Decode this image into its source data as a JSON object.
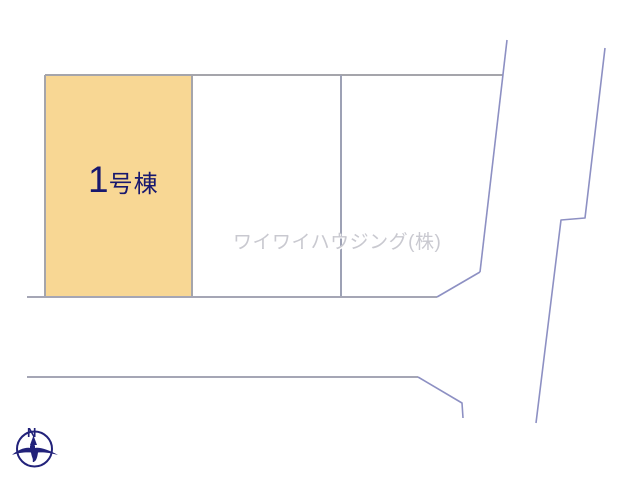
{
  "diagram": {
    "plot": {
      "label_number": "1",
      "label_suffix": "号棟",
      "full_label": "1号棟"
    },
    "watermark": "ワイワイハウジング(株)",
    "compass": {
      "north_label": "N"
    },
    "colors": {
      "plot_fill": "#f8d794",
      "plot_line": "#a5a5ab",
      "parcel_line": "#9da1b5",
      "road_line": "#a5a6b5",
      "boundary_line": "#8d90c3",
      "label_navy": "#18186e",
      "watermark_gray": "#c9c9d0",
      "compass_navy": "#22227a"
    }
  }
}
